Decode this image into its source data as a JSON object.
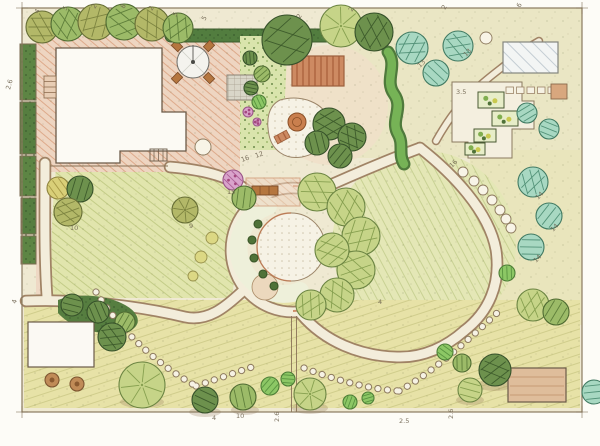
{
  "meta": {
    "title": "Hand-drawn landscape garden design plan (colored pencil site plan)",
    "type": "landscape-plan"
  },
  "palette": {
    "paper": "#fdfcf7",
    "ground": "#efe9d2",
    "lawn": "#e1e5ad",
    "path_fill": "#f3eddb",
    "path_edge": "#a08365",
    "patio_pink": "#eed5c1",
    "deck_terracotta": "#cd8a62",
    "hedge_dark": "#527d3f",
    "tree_light": "#c6d488",
    "tree_dark": "#6d914d",
    "tree_teal": "#a8d8c2",
    "flower_pink": "#d9a3cb",
    "building_white": "#fcfaf4",
    "building_tan": "#dfbd9b",
    "label_ink": "#6f6450"
  },
  "annotations": [
    {
      "text": "4",
      "x": 38,
      "y": 14,
      "rot": -60
    },
    {
      "text": "5",
      "x": 66,
      "y": 11,
      "rot": -60
    },
    {
      "text": "2",
      "x": 95,
      "y": 9,
      "rot": -60
    },
    {
      "text": "8",
      "x": 124,
      "y": 9,
      "rot": -60
    },
    {
      "text": "2",
      "x": 152,
      "y": 11,
      "rot": -60
    },
    {
      "text": "5",
      "x": 176,
      "y": 17,
      "rot": -60
    },
    {
      "text": "5",
      "x": 205,
      "y": 21,
      "rot": -60
    },
    {
      "text": "2",
      "x": 300,
      "y": 19,
      "rot": -60
    },
    {
      "text": "2",
      "x": 352,
      "y": 12,
      "rot": -60
    },
    {
      "text": "2",
      "x": 445,
      "y": 10,
      "rot": -60
    },
    {
      "text": "6",
      "x": 520,
      "y": 8,
      "rot": -60
    },
    {
      "text": "2.6",
      "x": 10,
      "y": 90,
      "rot": -75
    },
    {
      "text": "4",
      "x": 16,
      "y": 304,
      "rot": -75
    },
    {
      "text": "10",
      "x": 70,
      "y": 230,
      "rot": 0
    },
    {
      "text": "9",
      "x": 189,
      "y": 228,
      "rot": 0
    },
    {
      "text": "16",
      "x": 242,
      "y": 162,
      "rot": -20
    },
    {
      "text": "12",
      "x": 256,
      "y": 158,
      "rot": -20
    },
    {
      "text": "15",
      "x": 227,
      "y": 194,
      "rot": 0
    },
    {
      "text": "4",
      "x": 378,
      "y": 304,
      "rot": 0
    },
    {
      "text": "3.5",
      "x": 456,
      "y": 94,
      "rot": 0
    },
    {
      "text": "13",
      "x": 420,
      "y": 68,
      "rot": -45
    },
    {
      "text": "13",
      "x": 466,
      "y": 57,
      "rot": -45
    },
    {
      "text": "16",
      "x": 452,
      "y": 168,
      "rot": -45
    },
    {
      "text": "14",
      "x": 538,
      "y": 200,
      "rot": -45
    },
    {
      "text": "14",
      "x": 553,
      "y": 232,
      "rot": -45
    },
    {
      "text": "14",
      "x": 536,
      "y": 263,
      "rot": -45
    },
    {
      "text": "4",
      "x": 212,
      "y": 420,
      "rot": 0
    },
    {
      "text": "10",
      "x": 236,
      "y": 418,
      "rot": 0
    },
    {
      "text": "2.6",
      "x": 279,
      "y": 422,
      "rot": -90
    },
    {
      "text": "2.5",
      "x": 399,
      "y": 423,
      "rot": 0
    },
    {
      "text": "2.6",
      "x": 453,
      "y": 419,
      "rot": -90
    }
  ],
  "trees": [
    [
      42,
      27,
      16,
      "O",
      "h"
    ],
    [
      68,
      24,
      17,
      "M",
      "h"
    ],
    [
      96,
      22,
      18,
      "O",
      "h"
    ],
    [
      124,
      22,
      18,
      "M",
      "h"
    ],
    [
      152,
      24,
      17,
      "O",
      "h"
    ],
    [
      178,
      28,
      15,
      "M",
      "h"
    ],
    [
      287,
      40,
      25,
      "D",
      "h"
    ],
    [
      341,
      26,
      21,
      "L",
      "r"
    ],
    [
      374,
      32,
      19,
      "D",
      "h"
    ],
    [
      412,
      48,
      16,
      "T",
      "h"
    ],
    [
      458,
      46,
      15,
      "T",
      "h"
    ],
    [
      436,
      73,
      13,
      "T",
      "h"
    ],
    [
      486,
      38,
      6,
      "W",
      "n"
    ],
    [
      527,
      113,
      10,
      "T",
      "h"
    ],
    [
      549,
      129,
      10,
      "T",
      "h"
    ],
    [
      533,
      182,
      15,
      "T",
      "h"
    ],
    [
      549,
      216,
      13,
      "T",
      "h"
    ],
    [
      531,
      247,
      13,
      "T",
      "h"
    ],
    [
      58,
      188,
      11,
      "Y",
      "h"
    ],
    [
      80,
      189,
      13,
      "D",
      "h"
    ],
    [
      68,
      212,
      14,
      "O",
      "h"
    ],
    [
      185,
      210,
      13,
      "O",
      "r"
    ],
    [
      250,
      58,
      7,
      "D",
      "h"
    ],
    [
      262,
      74,
      8,
      "M",
      "h"
    ],
    [
      251,
      88,
      7,
      "D",
      "h"
    ],
    [
      259,
      102,
      7,
      "B",
      "h"
    ],
    [
      248,
      112,
      5,
      "P",
      "n"
    ],
    [
      257,
      122,
      4,
      "P",
      "n"
    ],
    [
      233,
      180,
      10,
      "P",
      "h"
    ],
    [
      244,
      198,
      12,
      "M",
      "h"
    ],
    [
      329,
      124,
      16,
      "D",
      "h"
    ],
    [
      352,
      137,
      14,
      "D",
      "h"
    ],
    [
      317,
      143,
      12,
      "D",
      "h"
    ],
    [
      340,
      156,
      12,
      "D",
      "h"
    ],
    [
      317,
      192,
      19,
      "L",
      "h"
    ],
    [
      346,
      207,
      19,
      "L",
      "h"
    ],
    [
      361,
      236,
      19,
      "L",
      "h"
    ],
    [
      356,
      270,
      19,
      "L",
      "h"
    ],
    [
      337,
      295,
      17,
      "L",
      "h"
    ],
    [
      311,
      305,
      15,
      "L",
      "h"
    ],
    [
      332,
      250,
      17,
      "L",
      "h"
    ],
    [
      258,
      224,
      4,
      "S",
      "n"
    ],
    [
      252,
      240,
      4,
      "S",
      "n"
    ],
    [
      254,
      258,
      4,
      "S",
      "n"
    ],
    [
      263,
      274,
      4,
      "S",
      "n"
    ],
    [
      274,
      286,
      4,
      "S",
      "n"
    ],
    [
      212,
      238,
      6,
      "YB",
      "n"
    ],
    [
      201,
      257,
      6,
      "YB",
      "n"
    ],
    [
      193,
      276,
      5,
      "YB",
      "n"
    ],
    [
      463,
      172,
      5,
      "W",
      "n"
    ],
    [
      474,
      181,
      5,
      "W",
      "n"
    ],
    [
      483,
      190,
      5,
      "W",
      "n"
    ],
    [
      492,
      200,
      5,
      "W",
      "n"
    ],
    [
      500,
      210,
      5,
      "W",
      "n"
    ],
    [
      506,
      219,
      5,
      "W",
      "n"
    ],
    [
      511,
      228,
      5,
      "W",
      "n"
    ],
    [
      507,
      273,
      8,
      "B",
      "h"
    ],
    [
      203,
      147,
      8,
      "W",
      "n"
    ],
    [
      72,
      305,
      11,
      "D",
      "h"
    ],
    [
      98,
      312,
      11,
      "D",
      "h"
    ],
    [
      125,
      322,
      10,
      "M",
      "h"
    ],
    [
      112,
      337,
      14,
      "D",
      "h"
    ],
    [
      142,
      385,
      23,
      "L",
      "r"
    ],
    [
      52,
      380,
      7,
      "TR",
      "n"
    ],
    [
      77,
      384,
      7,
      "TR",
      "n"
    ],
    [
      205,
      400,
      13,
      "D",
      "h"
    ],
    [
      243,
      397,
      13,
      "M",
      "h"
    ],
    [
      270,
      386,
      9,
      "B",
      "h"
    ],
    [
      288,
      379,
      7,
      "B",
      "h"
    ],
    [
      310,
      394,
      16,
      "L",
      "r"
    ],
    [
      350,
      402,
      7,
      "B",
      "h"
    ],
    [
      368,
      398,
      6,
      "B",
      "h"
    ],
    [
      445,
      352,
      8,
      "B",
      "h"
    ],
    [
      462,
      363,
      9,
      "M",
      "h"
    ],
    [
      495,
      370,
      16,
      "D",
      "h"
    ],
    [
      470,
      390,
      12,
      "L",
      "h"
    ],
    [
      533,
      305,
      16,
      "L",
      "h"
    ],
    [
      556,
      312,
      13,
      "M",
      "h"
    ],
    [
      594,
      392,
      12,
      "T",
      "h"
    ]
  ],
  "veg_beds": [
    [
      478,
      92,
      26,
      16
    ],
    [
      492,
      111,
      26,
      15
    ],
    [
      474,
      129,
      22,
      13
    ],
    [
      465,
      143,
      20,
      12
    ]
  ]
}
